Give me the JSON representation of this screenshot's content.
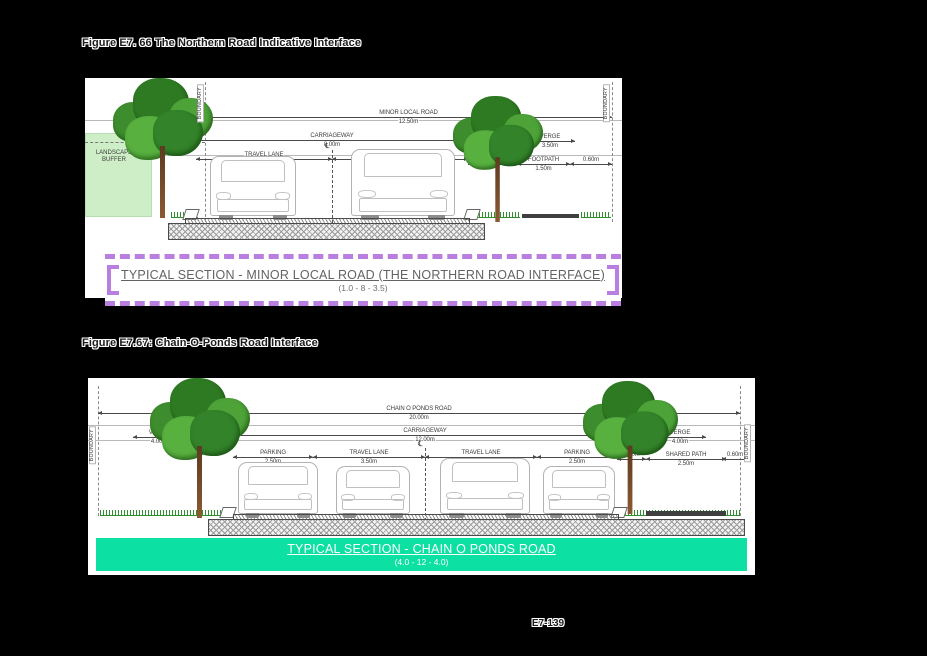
{
  "page": {
    "number": "E7-139"
  },
  "colors": {
    "caption_border": "#b97fe0",
    "banner_bg": "#0ce0a2",
    "buffer_bg": "#cdeec6"
  },
  "figure1": {
    "title": "Figure E7. 66 The Northern Road Indicative Interface",
    "labels": {
      "boundary": "BOUNDARY",
      "landscape_buffer": "LANDSCAPE BUFFER",
      "road_name": "MINOR LOCAL ROAD",
      "road_width": "12.50m",
      "carriageway": "CARRIAGEWAY",
      "carriageway_width": "8.00m",
      "verge": "VERGE",
      "verge_left_width": "1.20m",
      "verge_right_width": "3.50m",
      "travel_lane": "TRAVEL LANE",
      "travel_lane_width": "4.00m",
      "centerline": "℄",
      "offset_1": "1.40m",
      "footpath": "FOOTPATH",
      "footpath_width": "1.50m",
      "offset_2": "0.60m"
    },
    "caption": {
      "title": "TYPICAL SECTION - MINOR LOCAL ROAD (THE NORTHERN ROAD INTERFACE)",
      "dims": "(1.0 - 8 - 3.5)"
    }
  },
  "figure2": {
    "title": "Figure E7.67: Chain-O-Ponds Road Interface",
    "labels": {
      "boundary": "BOUNDARY",
      "road_name": "CHAIN O PONDS ROAD",
      "road_width": "20.00m",
      "carriageway": "CARRIAGEWAY",
      "carriageway_width": "12.00m",
      "verge": "VERGE",
      "verge_width": "4.00m",
      "parking": "PARKING",
      "parking_width": "2.50m",
      "travel_lane": "TRAVEL LANE",
      "travel_lane_width": "3.50m",
      "centerline": "℄",
      "offset_1": "0.90m",
      "shared_path": "SHARED PATH",
      "shared_path_width": "2.50m",
      "offset_2": "0.60m"
    },
    "caption": {
      "title": "TYPICAL SECTION - CHAIN O PONDS ROAD",
      "dims": "(4.0 - 12 - 4.0)"
    }
  }
}
